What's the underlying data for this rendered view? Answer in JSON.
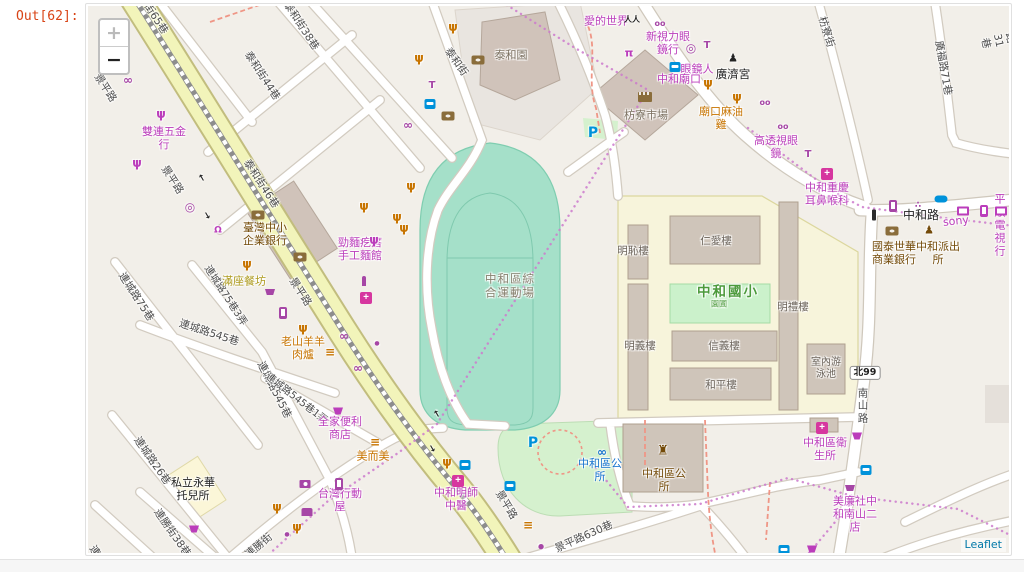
{
  "notebook": {
    "out_prompt": "Out[62]:"
  },
  "map": {
    "controls": {
      "zoom_in": "+",
      "zoom_out": "−"
    },
    "attribution": "Leaflet",
    "palette": {
      "mag": "#BB3DBB",
      "org": "#C77400",
      "brn": "#734A08",
      "brn2": "#8A6D3B",
      "tr": "#0092DA",
      "bik": "#1673CE",
      "purp": "#A646A6",
      "street": "#4C4C4C",
      "blk": "#222222",
      "olive": "#AD9A1C",
      "gb": "#7B7060",
      "grn": "#4C9A3C",
      "stad": "#87806E",
      "bldg": "#6B635A",
      "pharm": "#D6369F",
      "link": "#0078A8",
      "stadium_fill": "#A5E0C9",
      "school_fill": "#F7F4DB",
      "park_fill": "#D5F1CE",
      "building_fill": "#CFC5BA",
      "road_yellow": "#F2F4BA",
      "land": "#F2EFE9"
    },
    "labels": [
      {
        "t": "景平路",
        "x": 105,
        "y": 88,
        "r": 57,
        "c": "street",
        "s": 10.5,
        "n": "street-label"
      },
      {
        "t": "景平路",
        "x": 172,
        "y": 180,
        "r": 57,
        "c": "street",
        "s": 10.5,
        "n": "street-label"
      },
      {
        "t": "景平路",
        "x": 300,
        "y": 292,
        "r": 57,
        "c": "street",
        "s": 10.5,
        "n": "street-label"
      },
      {
        "t": "景平路",
        "x": 506,
        "y": 505,
        "r": 59,
        "c": "street",
        "s": 10.5,
        "n": "street-label"
      },
      {
        "t": "泰和街65巷",
        "x": 150,
        "y": 10,
        "r": 57,
        "c": "street",
        "s": 10.5,
        "n": "street-label"
      },
      {
        "t": "泰和街44巷",
        "x": 262,
        "y": 76,
        "r": 57,
        "c": "street",
        "s": 10.5,
        "n": "street-label"
      },
      {
        "t": "泰和街38巷",
        "x": 301,
        "y": 26,
        "r": 57,
        "c": "street",
        "s": 10.5,
        "n": "street-label"
      },
      {
        "t": "泰和街46巷",
        "x": 261,
        "y": 184,
        "r": 57,
        "c": "street",
        "s": 10.5,
        "n": "street-label"
      },
      {
        "t": "泰和街",
        "x": 456,
        "y": 62,
        "r": 55,
        "c": "street",
        "s": 10.5,
        "n": "street-label"
      },
      {
        "t": "枋寮街",
        "x": 826,
        "y": 32,
        "r": 73,
        "c": "street",
        "s": 10.5,
        "n": "street-label"
      },
      {
        "t": "廣福路71巷",
        "x": 943,
        "y": 68,
        "r": 80,
        "c": "street",
        "s": 10.5,
        "n": "street-label"
      },
      {
        "t": "廣濟路31巷",
        "x": 1010,
        "y": 38,
        "r": 78,
        "c": "street",
        "s": 10.5,
        "n": "street-label"
      },
      {
        "t": "中和路",
        "x": 921,
        "y": 215,
        "r": 0,
        "c": "blk",
        "s": 12,
        "n": "street-label"
      },
      {
        "t": "南\n山\n路",
        "x": 863,
        "y": 406,
        "r": 0,
        "c": "street",
        "s": 10.5,
        "n": "street-label"
      },
      {
        "t": "連城路75巷",
        "x": 136,
        "y": 297,
        "r": 57,
        "c": "street",
        "s": 10.5,
        "n": "street-label"
      },
      {
        "t": "連城路75巷3弄",
        "x": 225,
        "y": 296,
        "r": 57,
        "c": "street",
        "s": 10,
        "n": "street-label"
      },
      {
        "t": "連城路545巷",
        "x": 209,
        "y": 333,
        "r": 18,
        "c": "street",
        "s": 10.5,
        "n": "street-label"
      },
      {
        "t": "連城路545巷",
        "x": 274,
        "y": 390,
        "r": 63,
        "c": "street",
        "s": 10.5,
        "n": "street-label"
      },
      {
        "t": "連城路545巷1弄",
        "x": 296,
        "y": 399,
        "r": 38,
        "c": "street",
        "s": 10,
        "n": "street-label"
      },
      {
        "t": "連城路26巷",
        "x": 152,
        "y": 461,
        "r": 55,
        "c": "street",
        "s": 10.5,
        "n": "street-label"
      },
      {
        "t": "連勝街38巷",
        "x": 172,
        "y": 533,
        "r": 55,
        "c": "street",
        "s": 10.5,
        "n": "street-label"
      },
      {
        "t": "連勝街",
        "x": 259,
        "y": 546,
        "r": -40,
        "c": "street",
        "s": 10.5,
        "n": "street-label"
      },
      {
        "t": "景平路630巷",
        "x": 584,
        "y": 537,
        "r": -24,
        "c": "street",
        "s": 10.5,
        "n": "street-label"
      },
      {
        "t": "連城路",
        "x": 100,
        "y": 560,
        "r": 57,
        "c": "street",
        "s": 10.5,
        "n": "street-label"
      },
      {
        "t": "北99",
        "x": 865,
        "y": 373,
        "k": "shield",
        "c": "blk",
        "s": 9.5,
        "n": "route-shield"
      },
      {
        "t": "中和區綜\n合運動場",
        "x": 510,
        "y": 286,
        "c": "stad",
        "s": 11.5,
        "ls": 1,
        "n": "stadium-label"
      },
      {
        "t": "中和國小",
        "x": 728,
        "y": 293,
        "c": "grn",
        "s": 13.5,
        "b": 1,
        "ls": 2,
        "n": "school-label"
      },
      {
        "t": "園圃",
        "x": 719,
        "y": 304,
        "c": "grn",
        "s": 8,
        "n": "school-garden-label"
      },
      {
        "t": "仁愛樓",
        "x": 716,
        "y": 241,
        "c": "bldg",
        "s": 10.5,
        "n": "building-label"
      },
      {
        "t": "明恥樓",
        "x": 633,
        "y": 251,
        "c": "bldg",
        "s": 10.5,
        "n": "building-label"
      },
      {
        "t": "明義樓",
        "x": 640,
        "y": 346,
        "c": "bldg",
        "s": 10.5,
        "n": "building-label"
      },
      {
        "t": "明禮樓",
        "x": 793,
        "y": 307,
        "c": "bldg",
        "s": 10.5,
        "n": "building-label"
      },
      {
        "t": "信義樓",
        "x": 724,
        "y": 346,
        "c": "bldg",
        "s": 10.5,
        "n": "building-label"
      },
      {
        "t": "和平樓",
        "x": 721,
        "y": 385,
        "c": "bldg",
        "s": 10.5,
        "n": "building-label"
      },
      {
        "t": "室內游\n泳池",
        "x": 826,
        "y": 369,
        "c": "bldg",
        "s": 10,
        "n": "building-label"
      },
      {
        "t": "雙連五金\n行",
        "x": 164,
        "y": 139,
        "c": "mag",
        "n": "poi-label"
      },
      {
        "t": "愛的世界",
        "x": 606,
        "y": 22,
        "c": "mag",
        "n": "poi-label"
      },
      {
        "t": "新視力眼\n鏡行",
        "x": 668,
        "y": 44,
        "c": "mag",
        "n": "poi-label"
      },
      {
        "t": "眼鏡人",
        "x": 697,
        "y": 70,
        "c": "mag",
        "n": "poi-label"
      },
      {
        "t": "中和廟口",
        "x": 679,
        "y": 80,
        "c": "mag",
        "n": "poi-label"
      },
      {
        "t": "廣濟宮",
        "x": 733,
        "y": 75,
        "c": "blk",
        "s": 11.5,
        "n": "poi-label"
      },
      {
        "t": "枋寮市場",
        "x": 646,
        "y": 116,
        "c": "gb",
        "s": 11,
        "n": "poi-label"
      },
      {
        "t": "泰和園",
        "x": 511,
        "y": 56,
        "c": "gb",
        "s": 11,
        "n": "poi-label"
      },
      {
        "t": "廟口麻油\n雞",
        "x": 721,
        "y": 119,
        "c": "org",
        "n": "poi-label"
      },
      {
        "t": "高透視眼\n鏡",
        "x": 776,
        "y": 148,
        "c": "mag",
        "n": "poi-label"
      },
      {
        "t": "中和重慶\n耳鼻喉科",
        "x": 827,
        "y": 195,
        "c": "mag",
        "n": "poi-label"
      },
      {
        "t": "sony",
        "x": 956,
        "y": 222,
        "r": -6,
        "c": "mag",
        "s": 11,
        "n": "poi-label"
      },
      {
        "t": "平順電視行",
        "x": 1000,
        "y": 226,
        "c": "mag",
        "s": 11,
        "n": "poi-label"
      },
      {
        "t": "國泰世華\n商業銀行",
        "x": 894,
        "y": 254,
        "c": "brn",
        "n": "poi-label"
      },
      {
        "t": "中和派出\n所",
        "x": 938,
        "y": 254,
        "c": "brn",
        "n": "poi-label"
      },
      {
        "t": "臺灣中小\n企業銀行",
        "x": 265,
        "y": 235,
        "c": "brn",
        "n": "poi-label"
      },
      {
        "t": "滿座餐坊",
        "x": 244,
        "y": 282,
        "c": "olive",
        "n": "poi-label"
      },
      {
        "t": "勁麵疙瘩\n手工麵館",
        "x": 360,
        "y": 250,
        "c": "mag",
        "n": "poi-label"
      },
      {
        "t": "老山羊羊\n肉爐",
        "x": 303,
        "y": 349,
        "c": "org",
        "n": "poi-label"
      },
      {
        "t": "全家便利\n商店",
        "x": 340,
        "y": 429,
        "c": "mag",
        "n": "poi-label"
      },
      {
        "t": "美而美",
        "x": 373,
        "y": 457,
        "c": "org",
        "n": "poi-label"
      },
      {
        "t": "台灣行動\n屋",
        "x": 340,
        "y": 501,
        "c": "mag",
        "n": "poi-label"
      },
      {
        "t": "中和明師\n中醫",
        "x": 456,
        "y": 500,
        "c": "mag",
        "n": "poi-label"
      },
      {
        "t": "私立永華\n托兒所",
        "x": 193,
        "y": 490,
        "c": "blk",
        "n": "poi-label"
      },
      {
        "t": "中和區公\n所",
        "x": 600,
        "y": 471,
        "c": "bik",
        "n": "bike-station-label"
      },
      {
        "t": "中和區公\n所",
        "x": 664,
        "y": 481,
        "c": "brn",
        "n": "district-office-label"
      },
      {
        "t": "中和區衛\n生所",
        "x": 825,
        "y": 450,
        "c": "mag",
        "n": "poi-label"
      },
      {
        "t": "美廉社中\n和南山二\n店",
        "x": 855,
        "y": 515,
        "c": "mag",
        "n": "poi-label"
      }
    ],
    "icons": [
      {
        "t": "fork",
        "x": 161,
        "y": 114,
        "c": "mag"
      },
      {
        "t": "fork",
        "x": 137,
        "y": 163,
        "c": "mag"
      },
      {
        "t": "fork",
        "x": 374,
        "y": 240,
        "c": "mag"
      },
      {
        "t": "fork",
        "x": 453,
        "y": 27,
        "c": "org"
      },
      {
        "t": "fork",
        "x": 419,
        "y": 58,
        "c": "org"
      },
      {
        "t": "fork",
        "x": 411,
        "y": 186,
        "c": "org"
      },
      {
        "t": "fork",
        "x": 404,
        "y": 228,
        "c": "org"
      },
      {
        "t": "fork",
        "x": 364,
        "y": 206,
        "c": "org"
      },
      {
        "t": "fork",
        "x": 397,
        "y": 217,
        "c": "org"
      },
      {
        "t": "fork",
        "x": 247,
        "y": 264,
        "c": "org"
      },
      {
        "t": "fork",
        "x": 303,
        "y": 328,
        "c": "org"
      },
      {
        "t": "fork",
        "x": 447,
        "y": 462,
        "c": "org"
      },
      {
        "t": "fork",
        "x": 277,
        "y": 507,
        "c": "org"
      },
      {
        "t": "fork",
        "x": 297,
        "y": 527,
        "c": "org"
      },
      {
        "t": "fork",
        "x": 708,
        "y": 83,
        "c": "org"
      },
      {
        "t": "fork",
        "x": 737,
        "y": 97,
        "c": "org"
      },
      {
        "t": "burger",
        "x": 375,
        "y": 442,
        "c": "org"
      },
      {
        "t": "burger",
        "x": 330,
        "y": 352,
        "c": "org"
      },
      {
        "t": "burger",
        "x": 528,
        "y": 525,
        "c": "org"
      },
      {
        "t": "apple",
        "x": 541,
        "y": 547,
        "c": "purp",
        "s": 7
      },
      {
        "t": "scooter",
        "x": 128,
        "y": 80,
        "c": "purp"
      },
      {
        "t": "scooter",
        "x": 408,
        "y": 125,
        "c": "purp"
      },
      {
        "t": "scooter",
        "x": 344,
        "y": 336,
        "c": "purp"
      },
      {
        "t": "scooter",
        "x": 358,
        "y": 368,
        "c": "purp"
      },
      {
        "t": "bike",
        "x": 602,
        "y": 452,
        "c": "bik"
      },
      {
        "t": "cd",
        "x": 190,
        "y": 207,
        "c": "purp"
      },
      {
        "t": "ring",
        "x": 691,
        "y": 48,
        "c": "purp"
      },
      {
        "t": "glasses",
        "x": 660,
        "y": 24,
        "c": "purp",
        "s": 8
      },
      {
        "t": "glasses",
        "x": 765,
        "y": 103,
        "c": "purp",
        "s": 8
      },
      {
        "t": "glasses",
        "x": 783,
        "y": 127,
        "c": "purp",
        "s": 8
      },
      {
        "t": "shirt",
        "x": 432,
        "y": 86,
        "c": "purp",
        "s": 10
      },
      {
        "t": "shirt",
        "x": 808,
        "y": 155,
        "c": "purp",
        "s": 10
      },
      {
        "t": "shirt",
        "x": 707,
        "y": 46,
        "c": "purp",
        "s": 10
      },
      {
        "t": "people",
        "x": 632,
        "y": 20,
        "c": "blk",
        "s": 8
      },
      {
        "t": "person",
        "x": 733,
        "y": 58,
        "c": "blk",
        "s": 11
      },
      {
        "t": "police",
        "x": 929,
        "y": 230,
        "c": "brn",
        "s": 11
      },
      {
        "t": "gov",
        "x": 663,
        "y": 451,
        "c": "brn",
        "s": 13
      },
      {
        "t": "torii",
        "x": 629,
        "y": 53,
        "c": "mag",
        "s": 11
      },
      {
        "t": "paw",
        "x": 918,
        "y": 206,
        "c": "purp",
        "s": 9
      },
      {
        "t": "dot",
        "x": 377,
        "y": 344,
        "c": "purp",
        "s": 6
      },
      {
        "t": "dot",
        "x": 287,
        "y": 535,
        "c": "purp",
        "s": 6
      },
      {
        "t": "tooth",
        "x": 218,
        "y": 231,
        "c": "mag",
        "s": 9
      },
      {
        "t": "parking",
        "x": 533,
        "y": 443,
        "c": "tr",
        "s": 14
      },
      {
        "t": "parking",
        "x": 593,
        "y": 133,
        "c": "tr",
        "s": 14
      },
      {
        "t": "arrow",
        "x": 203,
        "y": 177,
        "c": "blk",
        "s": 9,
        "r": -120
      },
      {
        "t": "arrow",
        "x": 206,
        "y": 216,
        "c": "blk",
        "s": 9,
        "r": 60
      },
      {
        "t": "arrow",
        "x": 438,
        "y": 413,
        "c": "blk",
        "s": 9,
        "r": -120
      },
      {
        "t": "arrow",
        "x": 431,
        "y": 449,
        "c": "blk",
        "s": 9,
        "r": 60
      },
      {
        "t": "bus",
        "x": 430,
        "y": 104,
        "c": "tr"
      },
      {
        "t": "bus",
        "x": 675,
        "y": 67,
        "c": "tr"
      },
      {
        "t": "bus",
        "x": 510,
        "y": 486,
        "c": "tr"
      },
      {
        "t": "bus",
        "x": 465,
        "y": 465,
        "c": "tr"
      },
      {
        "t": "bus",
        "x": 866,
        "y": 470,
        "c": "tr"
      },
      {
        "t": "bus",
        "x": 784,
        "y": 550,
        "c": "tr"
      },
      {
        "t": "bank",
        "x": 258,
        "y": 215,
        "c": "brn2"
      },
      {
        "t": "bank",
        "x": 300,
        "y": 257,
        "c": "brn2"
      },
      {
        "t": "bank",
        "x": 478,
        "y": 60,
        "c": "brn2"
      },
      {
        "t": "bank",
        "x": 448,
        "y": 116,
        "c": "brn2"
      },
      {
        "t": "bank",
        "x": 892,
        "y": 231,
        "c": "brn2"
      },
      {
        "t": "pharmacy",
        "x": 366,
        "y": 298,
        "c": "pharm"
      },
      {
        "t": "pharmacy",
        "x": 827,
        "y": 174,
        "c": "pharm"
      },
      {
        "t": "pharmacy",
        "x": 822,
        "y": 428,
        "c": "pharm"
      },
      {
        "t": "pharmacy",
        "x": 458,
        "y": 481,
        "c": "pharm"
      },
      {
        "t": "phone",
        "x": 283,
        "y": 313,
        "c": "purp"
      },
      {
        "t": "phone",
        "x": 339,
        "y": 484,
        "c": "purp"
      },
      {
        "t": "phone",
        "x": 893,
        "y": 206,
        "c": "purp"
      },
      {
        "t": "phone",
        "x": 984,
        "y": 211,
        "c": "mag"
      },
      {
        "t": "tv",
        "x": 963,
        "y": 211,
        "c": "mag"
      },
      {
        "t": "tv",
        "x": 1001,
        "y": 211,
        "c": "mag"
      },
      {
        "t": "key",
        "x": 941,
        "y": 199,
        "c": "tr"
      },
      {
        "t": "camera",
        "x": 305,
        "y": 484,
        "c": "purp"
      },
      {
        "t": "sofa",
        "x": 307,
        "y": 512,
        "c": "purp"
      },
      {
        "t": "cart",
        "x": 270,
        "y": 292,
        "c": "purp"
      },
      {
        "t": "cart",
        "x": 850,
        "y": 488,
        "c": "purp"
      },
      {
        "t": "basket",
        "x": 338,
        "y": 411,
        "c": "mag"
      },
      {
        "t": "basket",
        "x": 194,
        "y": 529,
        "c": "mag"
      },
      {
        "t": "basket",
        "x": 857,
        "y": 436,
        "c": "mag"
      },
      {
        "t": "basket",
        "x": 812,
        "y": 549,
        "c": "mag"
      },
      {
        "t": "stall",
        "x": 645,
        "y": 97,
        "c": "brn2"
      },
      {
        "t": "signal",
        "x": 874,
        "y": 215,
        "c": "blk"
      },
      {
        "t": "bottle",
        "x": 364,
        "y": 281,
        "c": "purp"
      }
    ]
  }
}
